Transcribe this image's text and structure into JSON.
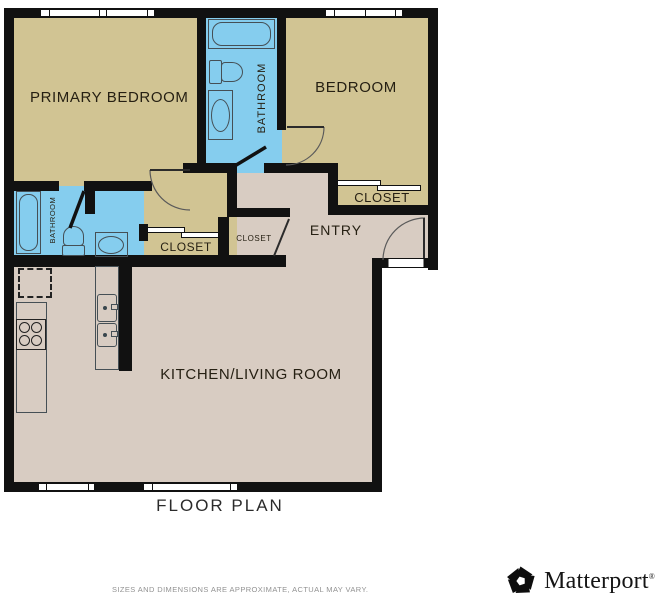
{
  "plan": {
    "title": "FLOOR PLAN",
    "disclaimer": "SIZES AND DIMENSIONS ARE APPROXIMATE, ACTUAL MAY VARY.",
    "brand": {
      "name": "Matterport",
      "reg": "®"
    },
    "colors": {
      "wall": "#111111",
      "bedroom_fill": "#d1c493",
      "bathroom_fill": "#85cdee",
      "living_fill": "#d8ccc2",
      "label_text": "#262013",
      "disclaimer_text": "#929292"
    },
    "rooms": [
      {
        "id": "primary-bedroom",
        "label": "PRIMARY BEDROOM"
      },
      {
        "id": "bathroom-top",
        "label": "BATHROOM"
      },
      {
        "id": "bedroom",
        "label": "BEDROOM"
      },
      {
        "id": "closet-bedroom",
        "label": "CLOSET"
      },
      {
        "id": "entry",
        "label": "ENTRY"
      },
      {
        "id": "closet-entry",
        "label": "CLOSET"
      },
      {
        "id": "closet-hall",
        "label": "CLOSET"
      },
      {
        "id": "bathroom-left",
        "label": "BATHROOM"
      },
      {
        "id": "kitchen-living",
        "label": "KITCHEN/LIVING ROOM"
      }
    ]
  }
}
